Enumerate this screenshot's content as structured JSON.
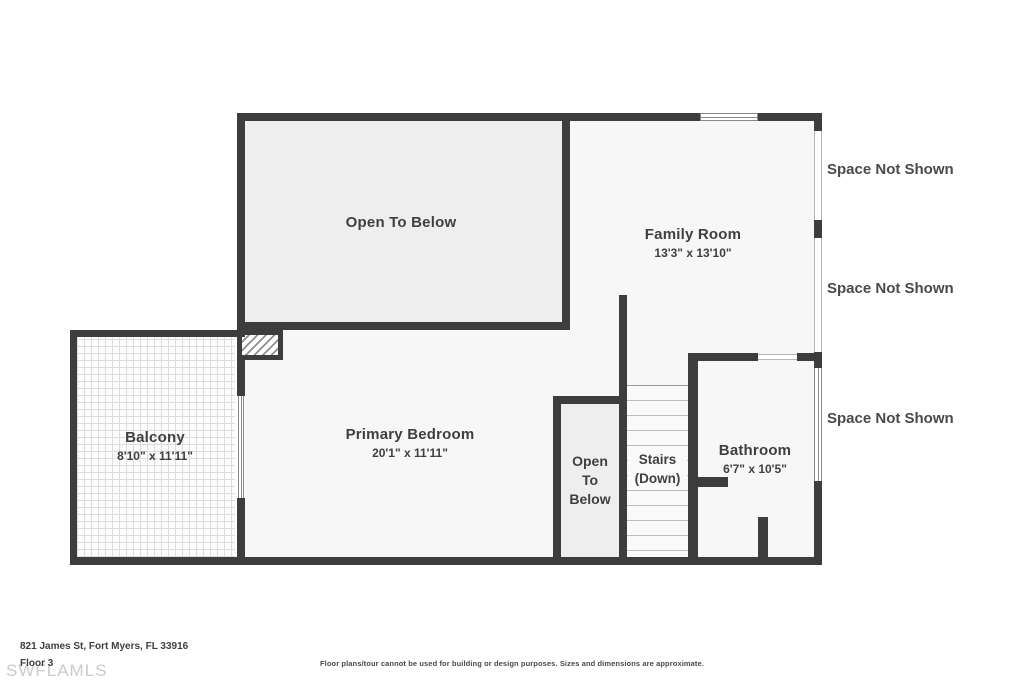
{
  "meta": {
    "address": "821 James St, Fort Myers, FL 33916",
    "floor_label": "Floor 3",
    "watermark": "SWFLAMLS",
    "disclaimer": "Floor plans/tour cannot be used for building or design purposes. Sizes and dimensions are approximate."
  },
  "rooms": {
    "open_to_below_main": {
      "name": "Open To Below"
    },
    "family_room": {
      "name": "Family Room",
      "dimensions": "13'3\" x 13'10\""
    },
    "primary_bedroom": {
      "name": "Primary Bedroom",
      "dimensions": "20'1\" x 11'11\""
    },
    "balcony": {
      "name": "Balcony",
      "dimensions": "8'10\" x 11'11\""
    },
    "bathroom": {
      "name": "Bathroom",
      "dimensions": "6'7\" x 10'5\""
    },
    "open_to_below_shaft": {
      "label": "Open\nTo\nBelow"
    },
    "stairs": {
      "label": "Stairs\n(Down)"
    }
  },
  "annotations": {
    "space_not_shown_1": "Space Not Shown",
    "space_not_shown_2": "Space Not Shown",
    "space_not_shown_3": "Space Not Shown"
  },
  "colors": {
    "wall": "#3d3d3d",
    "floor_fill": "#f7f7f7",
    "open_area_fill": "#eeeeee",
    "text": "#3f3f3f"
  }
}
